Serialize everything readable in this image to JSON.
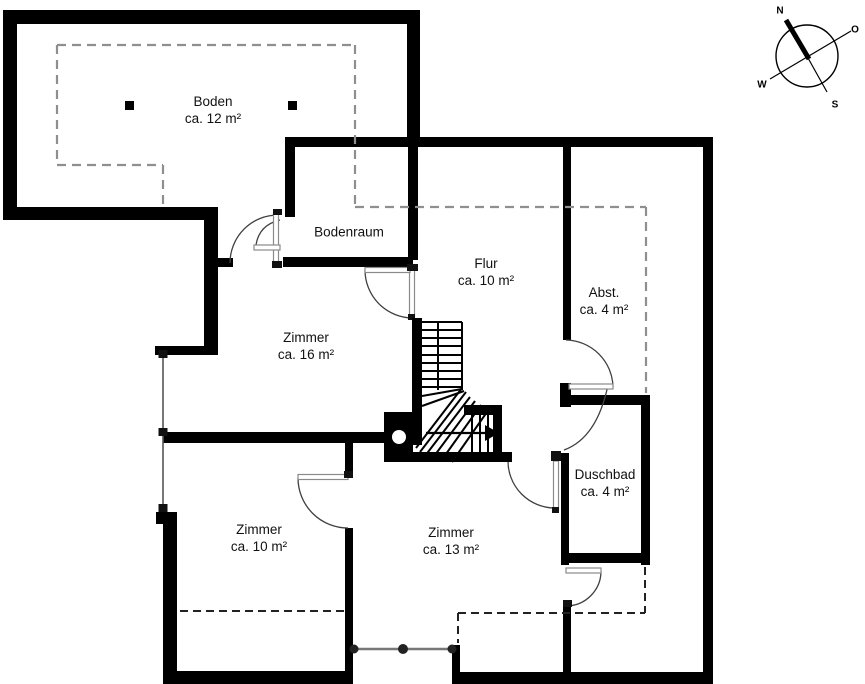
{
  "document": {
    "type": "floor-plan",
    "level": "attic-storey"
  },
  "rooms": [
    {
      "name": "Boden",
      "area": "ca. 12 m²"
    },
    {
      "name": "Bodenraum",
      "area": ""
    },
    {
      "name": "Flur",
      "area": "ca. 10 m²"
    },
    {
      "name": "Abst.",
      "area": "ca. 4 m²"
    },
    {
      "name": "Zimmer",
      "area": "ca. 16 m²"
    },
    {
      "name": "Duschbad",
      "area": "ca. 4 m²"
    },
    {
      "name": "Zimmer",
      "area": "ca. 10 m²"
    },
    {
      "name": "Zimmer",
      "area": "ca. 13 m²"
    }
  ],
  "compass": {
    "north": "N",
    "east": "O",
    "south": "S",
    "west": "W"
  },
  "colors": {
    "wall": "#000000",
    "dashed_gray": "#8f8f8f",
    "dashed_dark": "#222222",
    "door_arc": "#404040",
    "door_leaf_stroke": "#8a8a8a",
    "railing": "#777777",
    "background": "#ffffff",
    "label_text": "#111111"
  }
}
